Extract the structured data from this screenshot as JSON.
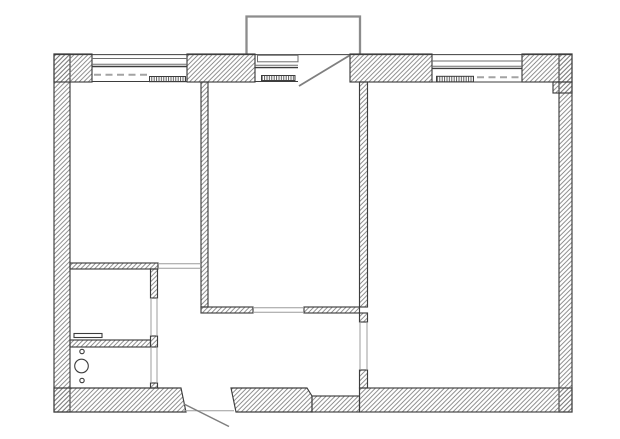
{
  "drawing": {
    "type": "apartment floor plan, two-room flat with balcony",
    "has_text": false,
    "rooms": [
      {
        "name": "room-left"
      },
      {
        "name": "room-center"
      },
      {
        "name": "room-right"
      },
      {
        "name": "bathroom"
      },
      {
        "name": "small-room"
      },
      {
        "name": "hallway"
      }
    ],
    "windows": [
      {
        "name": "left-room-window",
        "has_radiator": true,
        "has_dashed_lintel": true
      },
      {
        "name": "balcony-window",
        "has_radiator": true,
        "has_dashed_lintel": false
      },
      {
        "name": "right-room-window",
        "has_radiator": true,
        "has_dashed_lintel": true
      }
    ],
    "door_openings": [
      {
        "name": "balcony-door",
        "swing_line": true
      },
      {
        "name": "left-room-doorway",
        "swing_line": false
      },
      {
        "name": "center-room-doorway",
        "swing_line": false
      },
      {
        "name": "right-room-doorway",
        "swing_line": false
      },
      {
        "name": "bathroom-door",
        "swing_line": false
      },
      {
        "name": "small-room-door",
        "swing_line": false
      },
      {
        "name": "entrance-door",
        "swing_line": true
      }
    ],
    "balcony": {
      "present": true,
      "position": "top-center"
    },
    "fixtures": [
      {
        "name": "bathroom-shelf"
      },
      {
        "name": "burner-circle-small-top"
      },
      {
        "name": "burner-circle-large"
      },
      {
        "name": "burner-circle-small-bottom"
      }
    ],
    "radiators_count": 3
  },
  "colors": {
    "background": "#ffffff",
    "wall_line": "#3d3d3d",
    "hatch_line": "#7a7a7a",
    "window_frame": "#6e6e6e",
    "opening_line": "#9c9c9c",
    "dashed_line": "#a3a3a3",
    "balcony_line": "#8c8c8c",
    "swing_line": "#7f7f7f",
    "radiator_tick": "#4a4a4a"
  }
}
